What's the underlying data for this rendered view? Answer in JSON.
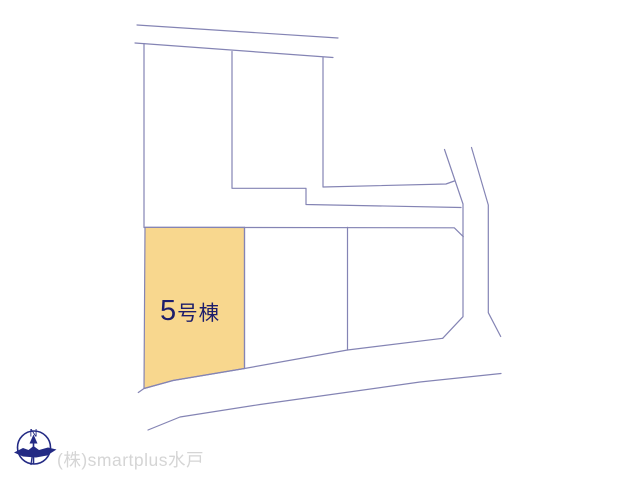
{
  "map": {
    "line_color": "#8484b4",
    "highlighted_parcel": {
      "label_number": "5",
      "label_suffix": "号棟",
      "label_full": "5号棟",
      "fill_color": "#f8d78e",
      "label_color": "#1d1d6b"
    }
  },
  "compass": {
    "north_label": "N",
    "color": "#232a84"
  },
  "watermark": {
    "text": "(株)smartplus水戸",
    "color": "#d5d5d5"
  }
}
